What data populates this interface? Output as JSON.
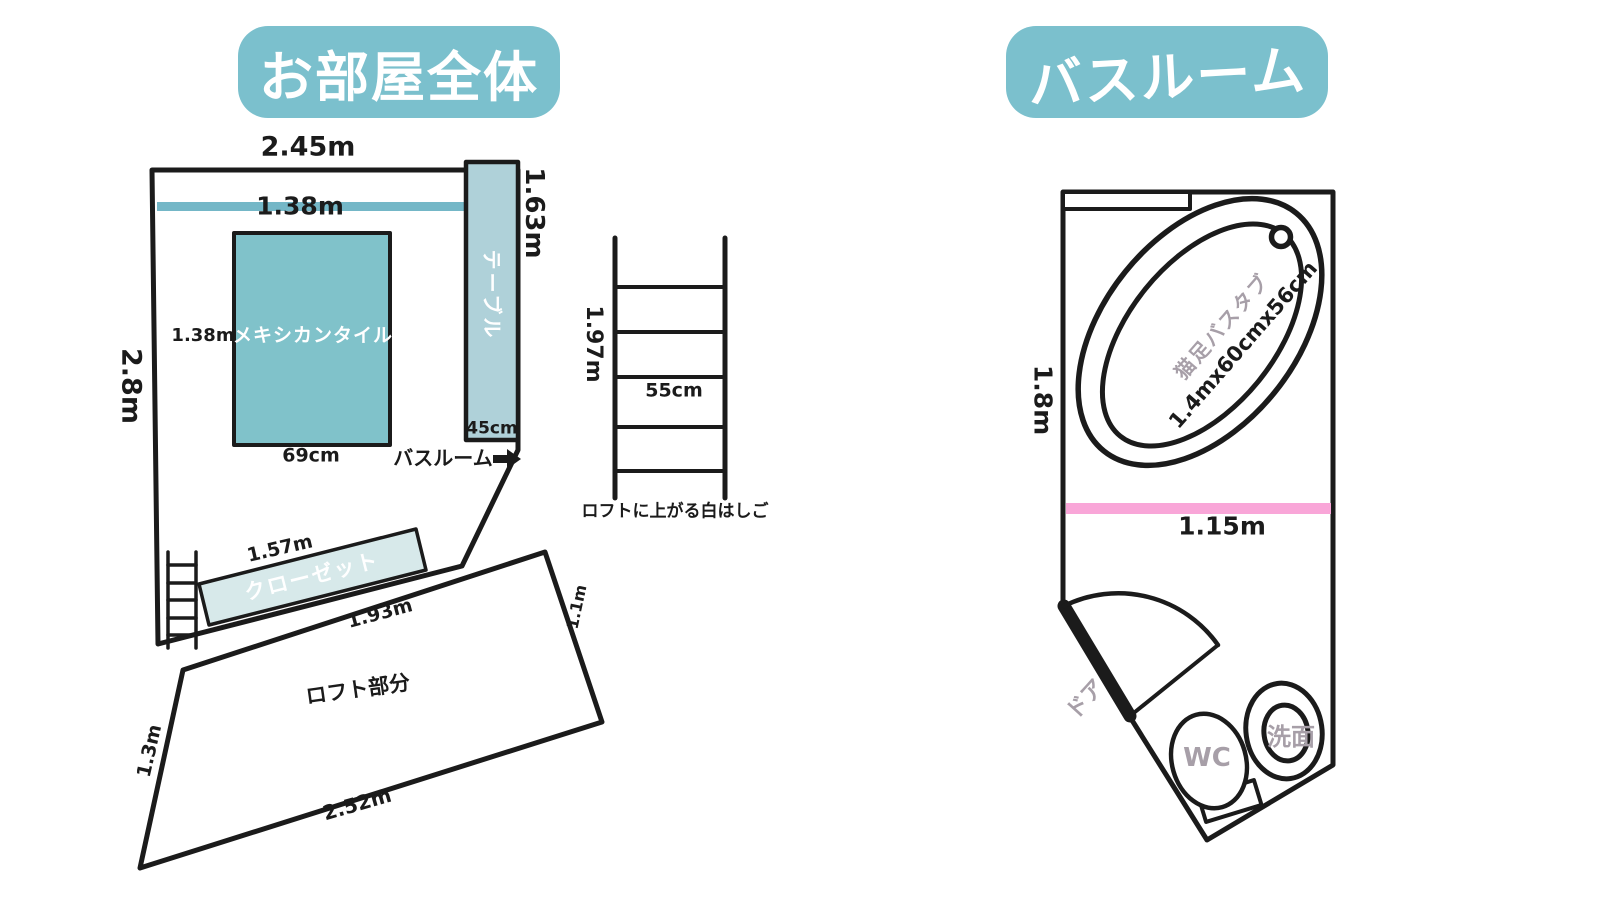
{
  "colors": {
    "badge": "#7bc0cd",
    "bar": "#74b7c7",
    "tile": "#80c2ca",
    "table": "#afd1d9",
    "closet": "#d7e9ea",
    "pink": "#f9a6d8",
    "gray_text": "#a79fa8",
    "line": "#1b1b1b"
  },
  "titles": {
    "room": "お部屋全体",
    "bathroom": "バスルーム"
  },
  "room_plan": {
    "top_width": "2.45m",
    "left_height": "2.8m",
    "bar_length": "1.38m",
    "tile": {
      "label": "メキシカンタイル",
      "height": "1.38m",
      "width": "69cm"
    },
    "table": {
      "label": "テーブル",
      "depth": "45cm",
      "length": "1.63m"
    },
    "bathroom_pointer": "バスルーム",
    "closet": {
      "label": "クローゼット",
      "length": "1.57m"
    },
    "bottom_wall_length": "1.93m",
    "loft": {
      "label": "ロフト部分",
      "left": "1.3m",
      "right": "1.1m",
      "bottom": "2.52m"
    }
  },
  "ladder": {
    "height": "1.97m",
    "width": "55cm",
    "caption": "ロフトに上がる白はしご"
  },
  "bathroom_plan": {
    "height": "1.8m",
    "width": "1.15m",
    "bathtub": {
      "name": "猫足バスタブ",
      "size": "1.4mx60cmx56cm"
    },
    "door_label": "ドア",
    "toilet_label": "WC",
    "sink_label": "洗面"
  }
}
